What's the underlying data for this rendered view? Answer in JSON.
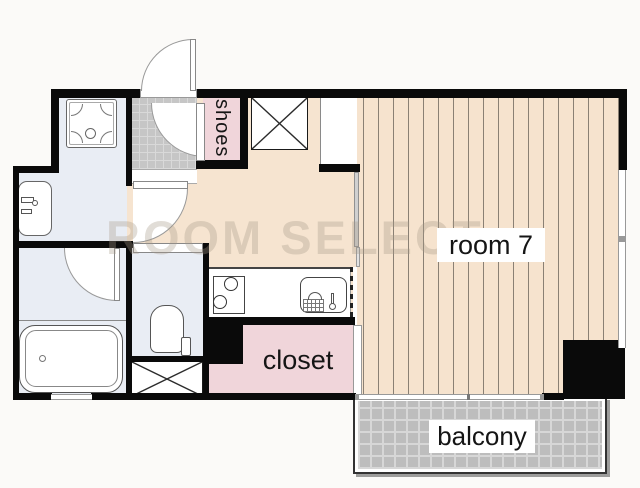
{
  "floorplan": {
    "watermark": "ROOM SELECT",
    "labels": {
      "room": "room 7",
      "closet": "closet",
      "shoes": "shoes",
      "balcony": "balcony"
    },
    "colors": {
      "room_floor": "#f6e3ce",
      "closet_pink": "#f0d5da",
      "wet_area_blue": "#e9edf4",
      "entry_tile_gray": "#c6c6c6",
      "balcony_tile_gray": "#bdbdbd",
      "wall_black": "#0a0a0a",
      "background": "#fbfaf8"
    }
  }
}
